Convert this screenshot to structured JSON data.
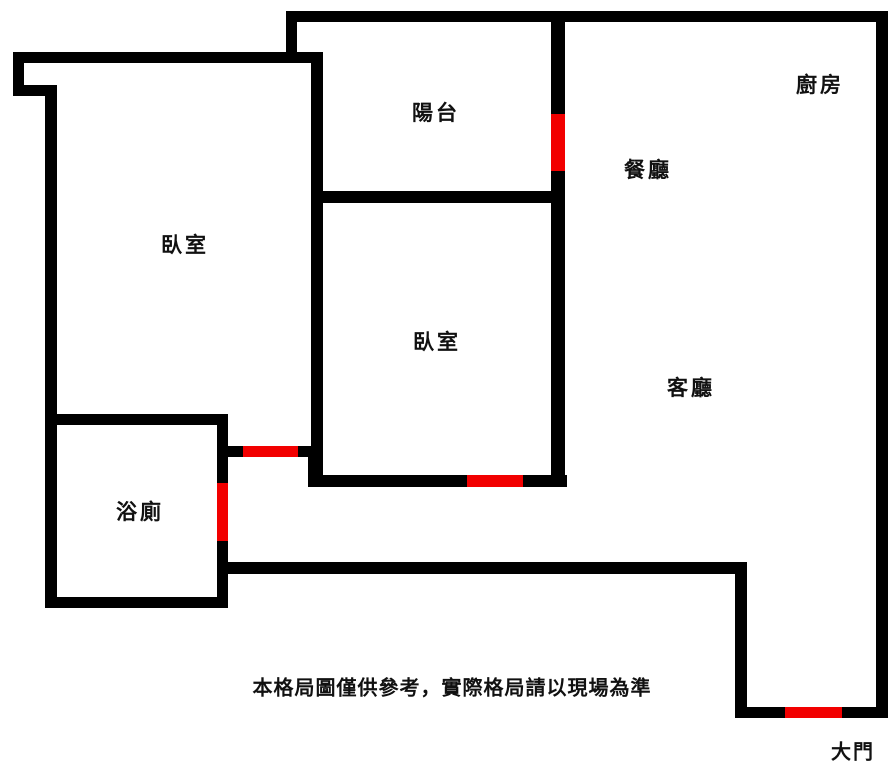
{
  "floorplan": {
    "colors": {
      "wall": "#000000",
      "opening": "#f20000",
      "background": "#ffffff",
      "text": "#111111"
    },
    "rooms": [
      {
        "id": "balcony",
        "label": "陽台"
      },
      {
        "id": "kitchen",
        "label": "廚房"
      },
      {
        "id": "dining-room",
        "label": "餐廳"
      },
      {
        "id": "bedroom-left",
        "label": "臥室"
      },
      {
        "id": "bedroom-middle",
        "label": "臥室"
      },
      {
        "id": "living-room",
        "label": "客廳"
      },
      {
        "id": "bathroom",
        "label": "浴廁"
      }
    ],
    "entrance_label": "大門",
    "disclaimer": "本格局圖僅供參考，實際格局請以現場為準"
  }
}
